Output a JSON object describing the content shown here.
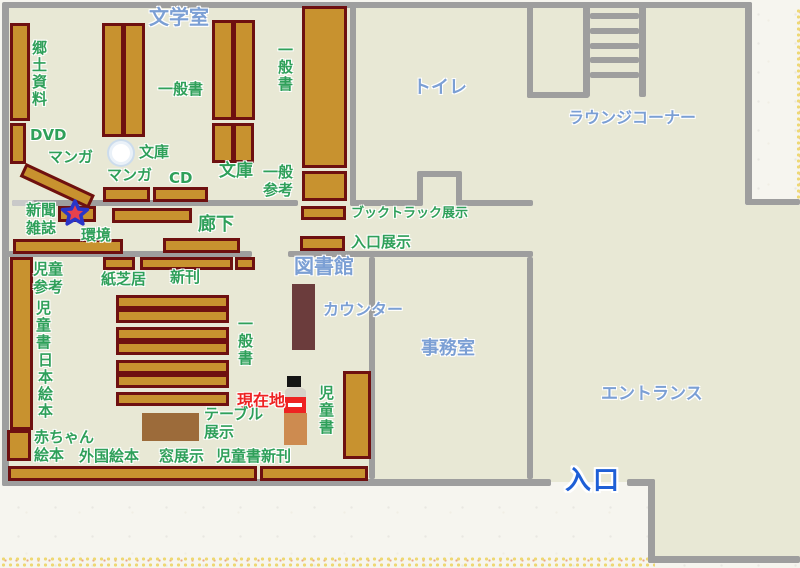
{
  "colors": {
    "floor": "#e8e8d5",
    "paper": "#f6f5ef",
    "wall": "#9e9e9e",
    "door": "#c9c9c9",
    "shelf_fill": "#c8922f",
    "shelf_border": "#6e1010",
    "counter_fill": "#6b3c3c",
    "table_fill": "#9c6b3a",
    "label_green": "#2fa05a",
    "label_blue": "#7b9fd4",
    "entrance_blue": "#1e5fd6",
    "current_red": "#ee2222",
    "star_fill": "#e8414d",
    "star_border": "#2a35c8",
    "marker_head": "#141414",
    "marker_collar": "#d6d2c8",
    "marker_body": "#cd8b50"
  },
  "rooms": {
    "literature_room": "文学室",
    "toilet": "トイレ",
    "lounge_corner": "ラウンジコーナー",
    "library": "図書館",
    "office": "事務室",
    "entrance_hall": "エントランス",
    "entrance_door": "入口",
    "corridor": "廊下",
    "counter": "カウンター"
  },
  "shelves": {
    "local_materials": "郷土資料",
    "dvd": "DVD",
    "manga_a": "マンガ",
    "manga_b": "マンガ",
    "general_top": "一般書",
    "general_right": "一般書",
    "general_center": "一般書",
    "bunko_a": "文庫",
    "bunko_b": "文庫",
    "cd": "CD",
    "general_reference": "一般\n参考",
    "newspaper_magazine": "新聞\n雑誌",
    "environment": "環境",
    "booktruck_display": "ブックトラック展示",
    "entrance_display": "入口展示",
    "kamishibai": "紙芝居",
    "new_arrivals": "新刊",
    "children_reference": "児童\n参考",
    "children_books_left": "児童書",
    "japanese_picture_books": "日本絵本",
    "children_books_right": "児童書",
    "table_display": "テーブル\n展示",
    "baby_picture_books": "赤ちゃん\n絵本",
    "foreign_picture_books": "外国絵本",
    "window_display": "窓展示",
    "children_new_arrivals": "児童書新刊"
  },
  "marker": {
    "current_location": "現在地"
  }
}
